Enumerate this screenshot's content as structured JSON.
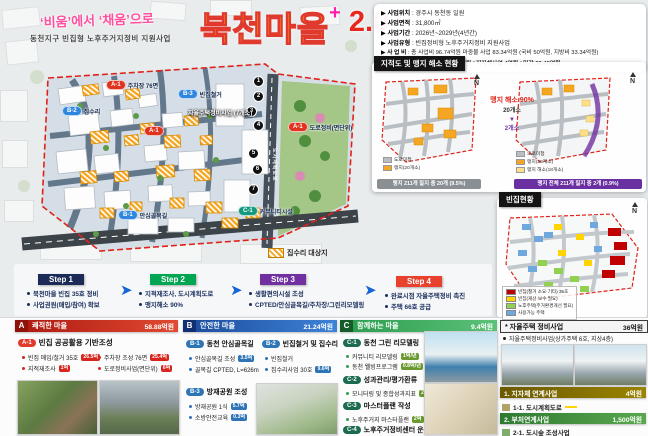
{
  "accents": {
    "red": "#e03a2f",
    "title_yellow": "#ffd400",
    "magenta": "#ff1fae",
    "navy": "#1b2a56",
    "green": "#00a651",
    "purple": "#7030a0",
    "blue": "#2e75b6",
    "dark_red": "#b01c12",
    "olive": "#6b5900",
    "dark_green": "#2f7a33"
  },
  "icons": {
    "steps_arrow": "➤"
  },
  "title": {
    "tagline": "‘비움’에서 ‘채움’으로",
    "subtitle": "동천지구 빈집형 노후주거지정비 지원사업",
    "main": "북천마을",
    "plus": "+",
    "version": "2.0"
  },
  "info": {
    "rows": [
      {
        "label": "▶ 사업위치",
        "value": ": 경주시 동천동 일원"
      },
      {
        "label": "▶ 사업면적",
        "value": ": 31,800㎡"
      },
      {
        "label": "▶ 사업기간",
        "value": ": 2026년~2029년(4년간)"
      },
      {
        "label": "▶ 사업유형",
        "value": ": 빈집정비형 노후주거지정비 지원사업"
      },
      {
        "label": "▶ 사 업 비",
        "value": ": 총 사업비 96.74억원 마중물 사업 83.34억원 (국비 50억원, 지방비 33.34억원)"
      }
    ],
    "sub": "자체지원비 8.92억원 / 지자체사업 4억원 / 민간 36.48억원"
  },
  "map": {
    "markers": [
      {
        "code": "A-1",
        "label": "주차장 76면"
      },
      {
        "code": "B-3",
        "label": "빈집철거"
      },
      {
        "code": "B-2",
        "label": "집수리"
      },
      {
        "code": "A-1",
        "label": ""
      },
      {
        "code": "A-1",
        "label": "도로정비(면단위)"
      },
      {
        "code": "B-1",
        "label": "안심골목길"
      },
      {
        "code": "C-1",
        "label": "커뮤니티시설"
      }
    ],
    "numbers": [
      "1",
      "2",
      "3",
      "4",
      "5",
      "6",
      "7"
    ],
    "cluster_label": "자율주택정비사업 (7개소)",
    "road_label": "도시계획도로",
    "repair_label": "집수리 대상지"
  },
  "cadastral": {
    "header": "지적도 및 맹지 해소 현황",
    "highlight": "맹지 해소 90%",
    "from": "20개소",
    "arrow": "▼",
    "to": "2개소",
    "left_caption": "맹지 211개 필지 중 20개 (9.5%)",
    "right_caption": "맹지 전체 211개 필지 중 2개 (0.9%)",
    "legend_left": [
      {
        "label": "도로미접"
      },
      {
        "label": "맹지(20개소)"
      }
    ],
    "legend_right": [
      {
        "label": "도로미접"
      },
      {
        "label": "맹지(20개소)"
      },
      {
        "label": "맹지 해소(18개소)"
      }
    ],
    "compass": "N"
  },
  "vacancy": {
    "header": "빈집현황",
    "legend": [
      {
        "label": "빈집(철거 소요·기타) 35호"
      },
      {
        "label": "빈집(개선·보수 필요)"
      },
      {
        "label": "노후주택(주거환경개선 필요)"
      },
      {
        "label": "사용가능 주택"
      }
    ],
    "compass": "N"
  },
  "steps": [
    {
      "label": "Step 1",
      "lines": [
        "북천마을 빈집 35호 정비",
        "사업권원(매입/참여) 확보"
      ]
    },
    {
      "label": "Step 2",
      "lines": [
        "지적재조사, 도시계획도로",
        "맹지해소 90%"
      ]
    },
    {
      "label": "Step 3",
      "lines": [
        "생활편의시설 조성",
        "CPTED/안심골목길/주차장/그린리모델링"
      ]
    },
    {
      "label": "Step 4",
      "lines": [
        "완료시점 자율주택정비 촉진",
        "주택 66호 공급"
      ]
    }
  ],
  "sectionA": {
    "letter": "A",
    "title": "쾌적한 마을",
    "budget": "58.88억원",
    "code": "A-1",
    "subtitle": "빈집 공공활용 기반조성",
    "left": [
      {
        "text": "빈집 매입/철거 35호",
        "badge": "26.5억"
      },
      {
        "text": "지적재조사",
        "badge": "1억"
      }
    ],
    "right": [
      {
        "text": "주차장 조성 76면",
        "badge": "25.4억"
      },
      {
        "text": "도로정비사업(면단위)",
        "badge": "6억"
      }
    ]
  },
  "sectionB": {
    "letter": "B",
    "title": "안전한 마을",
    "budget": "21.24억원",
    "subs": [
      {
        "code": "B-1",
        "title": "동천 안심골목길",
        "bullets": [
          {
            "text": "안심골목길 조성",
            "badge": "3.5억"
          },
          {
            "text": "골목길 CPTED, L=626m",
            "badge": ""
          }
        ]
      },
      {
        "code": "B-2",
        "title": "빈집철거 및 집수리",
        "bullets": [
          {
            "text": "빈집철거",
            "badge": ""
          },
          {
            "text": "집수리사업 30호",
            "badge": "9.6억"
          }
        ]
      },
      {
        "code": "B-3",
        "title": "방재공원 조성",
        "bullets": [
          {
            "text": "방재공원 1식",
            "badge": "5.7억"
          },
          {
            "text": "소방안전교육",
            "badge": "0.3억"
          }
        ]
      }
    ]
  },
  "sectionC": {
    "letter": "C",
    "title": "함께하는 마을",
    "budget": "9.4억원",
    "subs": [
      {
        "code": "C-1",
        "title": "동천 그린 리모델링",
        "bullets": [
          {
            "text": "커뮤니티 리모델링",
            "badge": "1억/년"
          },
          {
            "text": "동천 웰빙프로그램",
            "badge": "0.8억/년"
          }
        ]
      },
      {
        "code": "C-2",
        "title": "성과관리/평가환류",
        "bullets": [
          {
            "text": "모니터링 및 종합성과지표",
            "badge": "2.8억"
          }
        ]
      },
      {
        "code": "C-3",
        "title": "마스터플랜 작성",
        "bullets": [
          {
            "text": "노후주거지 마스터플랜",
            "badge": "2억"
          }
        ]
      },
      {
        "code": "C-4",
        "title": "노후주거정비센터 운영",
        "bullets": []
      }
    ]
  },
  "sectionD": {
    "title": "* 자율주택 정비사업",
    "budget": "36억원",
    "bullet": "자율주택정비사업(상가주택 6호, 지상4층)",
    "links": [
      {
        "name": "1. 지자체 연계사업",
        "budget": "4억원",
        "item": "1-1. 도시계획도로"
      },
      {
        "name": "2. 부처연계사업",
        "budget": "1,500억원",
        "item": "2-1. 도시숲 조성사업"
      }
    ]
  }
}
